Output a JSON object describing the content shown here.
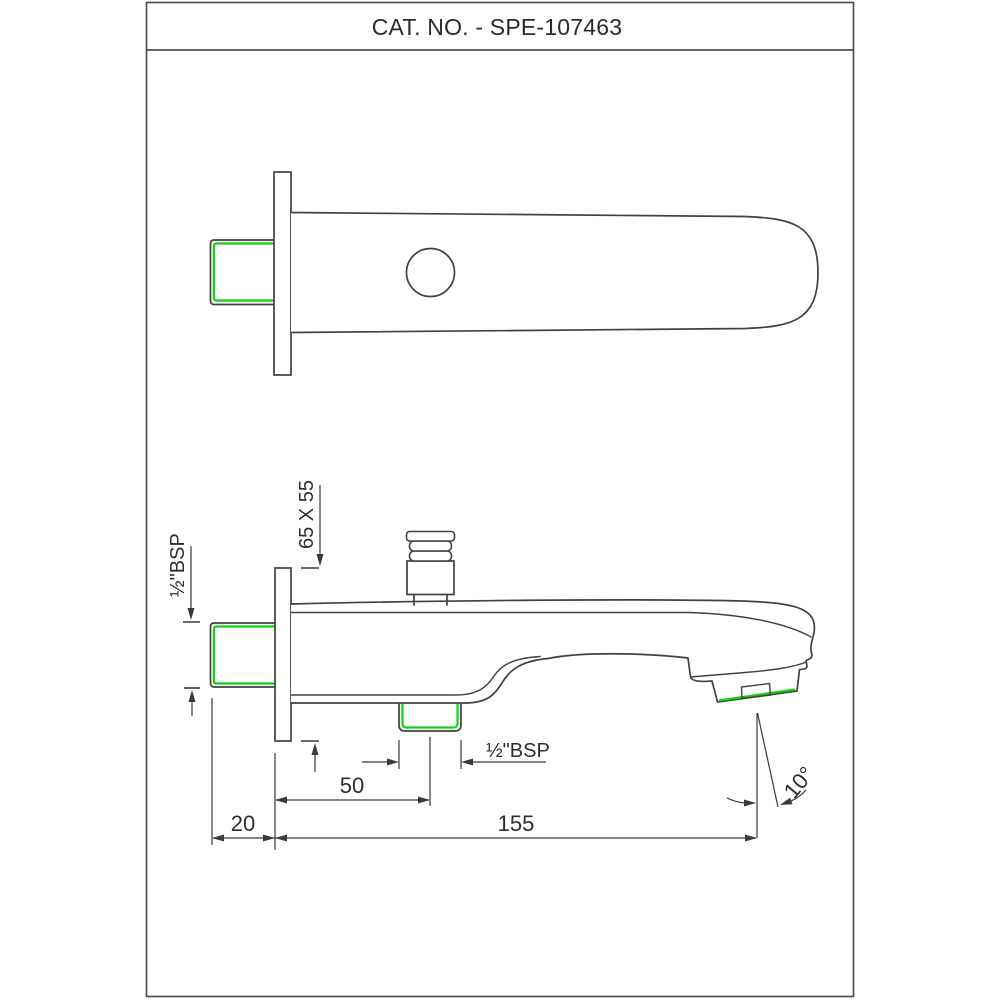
{
  "title_block": {
    "catalog_label": "CAT. NO. - SPE-107463"
  },
  "annotations": {
    "flange_size": "65 X 55",
    "inlet_thread": "½\"BSP",
    "outlet_thread": "½\"BSP",
    "spout_outlet_offset": "50",
    "wall_projection": "20",
    "total_length": "155",
    "spray_angle": "10°"
  },
  "colors": {
    "drawing_line": "#414141",
    "dimension_line": "#3a3a3a",
    "thread_highlight": "#12d112",
    "frame_border": "#4f4f4f",
    "text": "#2e2e2e",
    "background": "#ffffff"
  }
}
